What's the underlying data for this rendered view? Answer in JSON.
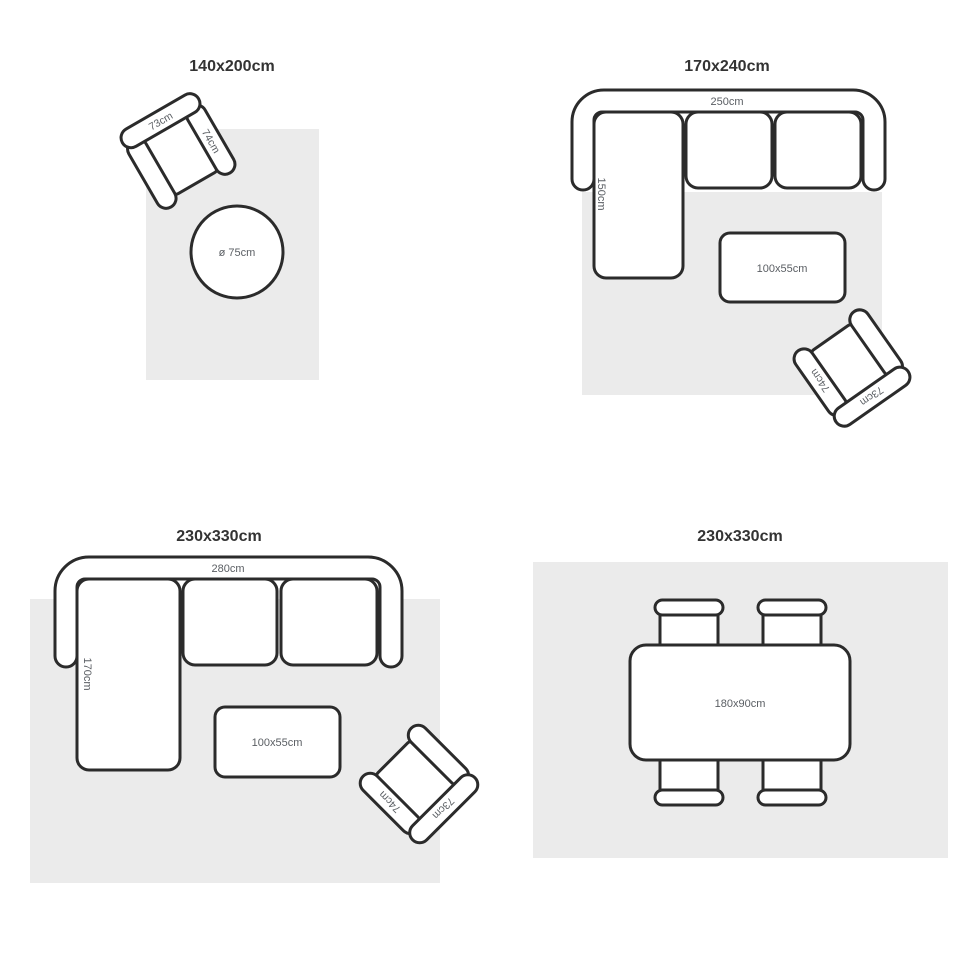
{
  "colors": {
    "background": "#ffffff",
    "rug": "#ebebeb",
    "furniture_fill": "#ffffff",
    "outline": "#2b2b2b",
    "label_text": "#5a5e63",
    "title_text": "#333333"
  },
  "panels": [
    {
      "title": "140x200cm",
      "armchair": {
        "back_label": "73cm",
        "arm_label": "74cm"
      },
      "round_table": {
        "label": "ø 75cm"
      }
    },
    {
      "title": "170x240cm",
      "sofa": {
        "width_label": "250cm",
        "depth_label": "150cm"
      },
      "coffee_table": {
        "label": "100x55cm"
      },
      "armchair": {
        "back_label": "73cm",
        "arm_label": "74cm"
      }
    },
    {
      "title": "230x330cm",
      "sofa": {
        "width_label": "280cm",
        "depth_label": "170cm"
      },
      "coffee_table": {
        "label": "100x55cm"
      },
      "armchair": {
        "back_label": "73cm",
        "arm_label": "74cm"
      }
    },
    {
      "title": "230x330cm",
      "dining_table": {
        "label": "180x90cm"
      }
    }
  ]
}
